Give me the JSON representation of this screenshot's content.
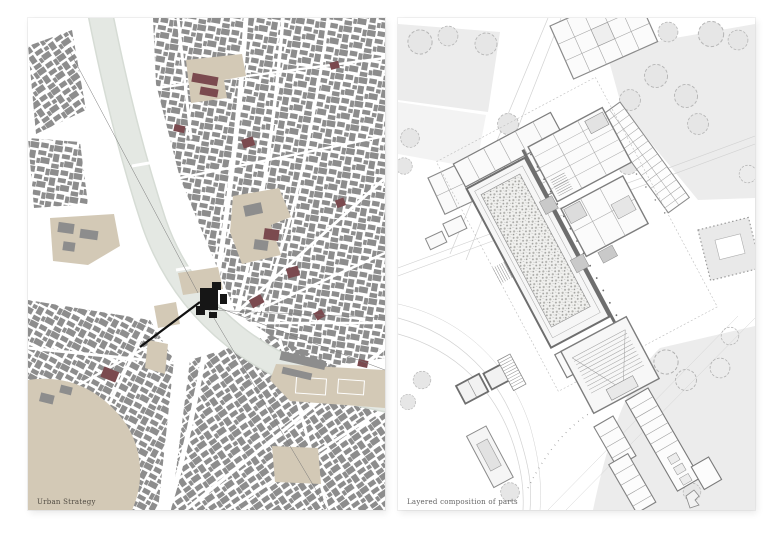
{
  "captions": {
    "left": "Urban Strategy",
    "right": "Layered composition of parts"
  },
  "panels": {
    "left_type": "urban figure-ground map",
    "right_type": "architectural site plan"
  },
  "palette": {
    "background": "#ffffff",
    "map_building_gray": "#8d8d8d",
    "map_river": "#e3e7e2",
    "map_landmark_beige": "#d3c9b6",
    "map_accent_maroon": "#7b4a4f",
    "map_site_black": "#161616",
    "plan_linework": "#8a8a8a",
    "plan_wall_dark": "#6e6e6e",
    "plan_ground": "#ececec",
    "plan_tree_stroke": "#b6b6b6"
  }
}
